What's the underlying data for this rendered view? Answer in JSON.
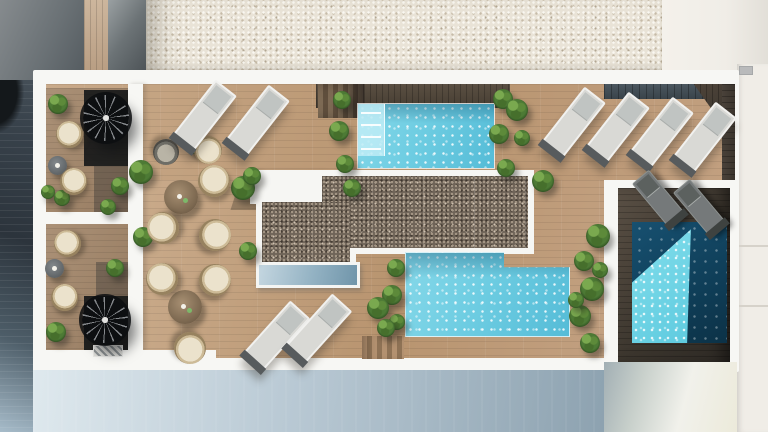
{
  "scene": {
    "description": "Photorealistic top-down 3D architectural render of a rooftop pool terrace between a gravel roof and a shadowed street",
    "view": "top-down aerial plan",
    "lighting": "hard daylight from upper-left casting long shadows",
    "counts": {
      "pools": 3,
      "white_loungers": 8,
      "grey_loungers": 2,
      "dining_sets": 2,
      "balconies": 2,
      "spiral_staircases": 2
    }
  },
  "palette": {
    "gravel": "#e9e3d7",
    "gravel_dot_light": "#faf8f2",
    "gravel_dot_dark": "#c6bba8",
    "deck_light": "#c9aa8a",
    "pebble": "#6f6458",
    "white_wall": "#f7f7f4",
    "pool_light": "#86d8e9",
    "pool_light_deep": "#55bcd7",
    "pool_dark": "#175070",
    "pool_sunlit": "#84dfec",
    "facade": "#8da2b0",
    "plant_light": "#7aa94f",
    "plant_mid": "#4d7a35",
    "plant_dark": "#2a4a1e",
    "lounger_white": "#d9d9d5",
    "lounger_grey": "#75797a",
    "cushion": "#ebe2cc",
    "wicker": "#97825f"
  },
  "objects": {
    "pools": [
      {
        "name": "top-pool",
        "x": 358,
        "y": 104,
        "w": 136,
        "h": 64,
        "tone": "light",
        "steps": true,
        "shade": true,
        "notch": false
      },
      {
        "name": "bottom-pool",
        "x": 405,
        "y": 252,
        "w": 165,
        "h": 85,
        "tone": "light",
        "steps": false,
        "shade": true,
        "notch": true
      },
      {
        "name": "plunge-pool",
        "x": 632,
        "y": 222,
        "w": 95,
        "h": 121,
        "tone": "dark",
        "steps": false,
        "shade": false,
        "notch": false
      }
    ],
    "loungers": [
      {
        "x": 203,
        "y": 117,
        "rot": 38,
        "v": "w"
      },
      {
        "x": 256,
        "y": 122,
        "rot": 38,
        "v": "w"
      },
      {
        "x": 275,
        "y": 337,
        "rot": 42,
        "v": "w"
      },
      {
        "x": 317,
        "y": 330,
        "rot": 42,
        "v": "w"
      },
      {
        "x": 572,
        "y": 124,
        "rot": 38,
        "v": "w"
      },
      {
        "x": 616,
        "y": 129,
        "rot": 38,
        "v": "w"
      },
      {
        "x": 660,
        "y": 134,
        "rot": 38,
        "v": "w"
      },
      {
        "x": 703,
        "y": 139,
        "rot": 38,
        "v": "w"
      },
      {
        "x": 659,
        "y": 199,
        "rot": -40,
        "v": "g"
      },
      {
        "x": 700,
        "y": 208,
        "rot": -40,
        "v": "g"
      }
    ],
    "chairs": [
      {
        "x": 214,
        "y": 181,
        "d": 32,
        "rot": 10
      },
      {
        "x": 215,
        "y": 235,
        "d": 32,
        "rot": 80
      },
      {
        "x": 163,
        "y": 228,
        "d": 32,
        "rot": -60
      },
      {
        "x": 208,
        "y": 150,
        "d": 28,
        "rot": 150
      },
      {
        "x": 166,
        "y": 152,
        "d": 26,
        "rot": 180,
        "v": "g"
      },
      {
        "x": 162,
        "y": 279,
        "d": 32,
        "rot": -30
      },
      {
        "x": 215,
        "y": 280,
        "d": 32,
        "rot": 60
      },
      {
        "x": 190,
        "y": 348,
        "d": 32,
        "rot": 170
      },
      {
        "x": 69,
        "y": 134,
        "d": 27,
        "rot": -25
      },
      {
        "x": 73,
        "y": 181,
        "d": 27,
        "rot": 20
      },
      {
        "x": 67,
        "y": 243,
        "d": 27,
        "rot": -35
      },
      {
        "x": 64,
        "y": 297,
        "d": 27,
        "rot": 15
      }
    ],
    "tables": [
      {
        "x": 181,
        "y": 197,
        "d": 34,
        "v": "wood",
        "drinks": 2
      },
      {
        "x": 185,
        "y": 307,
        "d": 34,
        "v": "wood",
        "drinks": 2
      },
      {
        "x": 57,
        "y": 165,
        "d": 19,
        "v": "grey",
        "drinks": 1
      },
      {
        "x": 54,
        "y": 268,
        "d": 19,
        "v": "grey",
        "drinks": 1
      }
    ],
    "plants": [
      {
        "x": 141,
        "y": 172,
        "r": 12
      },
      {
        "x": 143,
        "y": 237,
        "r": 10
      },
      {
        "x": 120,
        "y": 186,
        "r": 9
      },
      {
        "x": 115,
        "y": 268,
        "r": 9
      },
      {
        "x": 58,
        "y": 104,
        "r": 10
      },
      {
        "x": 48,
        "y": 192,
        "r": 7
      },
      {
        "x": 62,
        "y": 198,
        "r": 8
      },
      {
        "x": 56,
        "y": 332,
        "r": 10
      },
      {
        "x": 108,
        "y": 207,
        "r": 8
      },
      {
        "x": 195,
        "y": 146,
        "r": 8
      },
      {
        "x": 243,
        "y": 188,
        "r": 12
      },
      {
        "x": 252,
        "y": 176,
        "r": 9
      },
      {
        "x": 248,
        "y": 251,
        "r": 9
      },
      {
        "x": 352,
        "y": 188,
        "r": 9
      },
      {
        "x": 342,
        "y": 100,
        "r": 9
      },
      {
        "x": 339,
        "y": 131,
        "r": 10
      },
      {
        "x": 345,
        "y": 164,
        "r": 9
      },
      {
        "x": 503,
        "y": 99,
        "r": 10
      },
      {
        "x": 499,
        "y": 134,
        "r": 10
      },
      {
        "x": 506,
        "y": 168,
        "r": 9
      },
      {
        "x": 517,
        "y": 110,
        "r": 11
      },
      {
        "x": 522,
        "y": 138,
        "r": 8
      },
      {
        "x": 543,
        "y": 181,
        "r": 11
      },
      {
        "x": 598,
        "y": 236,
        "r": 12
      },
      {
        "x": 396,
        "y": 268,
        "r": 9
      },
      {
        "x": 392,
        "y": 295,
        "r": 10
      },
      {
        "x": 397,
        "y": 322,
        "r": 8
      },
      {
        "x": 378,
        "y": 308,
        "r": 11
      },
      {
        "x": 386,
        "y": 328,
        "r": 9
      },
      {
        "x": 584,
        "y": 261,
        "r": 10
      },
      {
        "x": 592,
        "y": 289,
        "r": 12
      },
      {
        "x": 580,
        "y": 316,
        "r": 11
      },
      {
        "x": 590,
        "y": 343,
        "r": 10
      },
      {
        "x": 600,
        "y": 270,
        "r": 8
      },
      {
        "x": 576,
        "y": 300,
        "r": 8
      }
    ],
    "spiral_stairs": [
      {
        "x": 83,
        "y": 95,
        "d": 46
      },
      {
        "x": 82,
        "y": 297,
        "d": 46
      }
    ],
    "stairs": [
      {
        "x": 318,
        "y": 84,
        "w": 46,
        "h": 34,
        "style": "shade-r"
      },
      {
        "x": 362,
        "y": 336,
        "w": 42,
        "h": 23,
        "style": "light"
      }
    ],
    "skylights": [
      {
        "x": 256,
        "y": 262,
        "w": 104,
        "h": 26
      }
    ],
    "vents": [
      {
        "x": 93,
        "y": 345,
        "w": 30,
        "h": 12
      }
    ]
  }
}
